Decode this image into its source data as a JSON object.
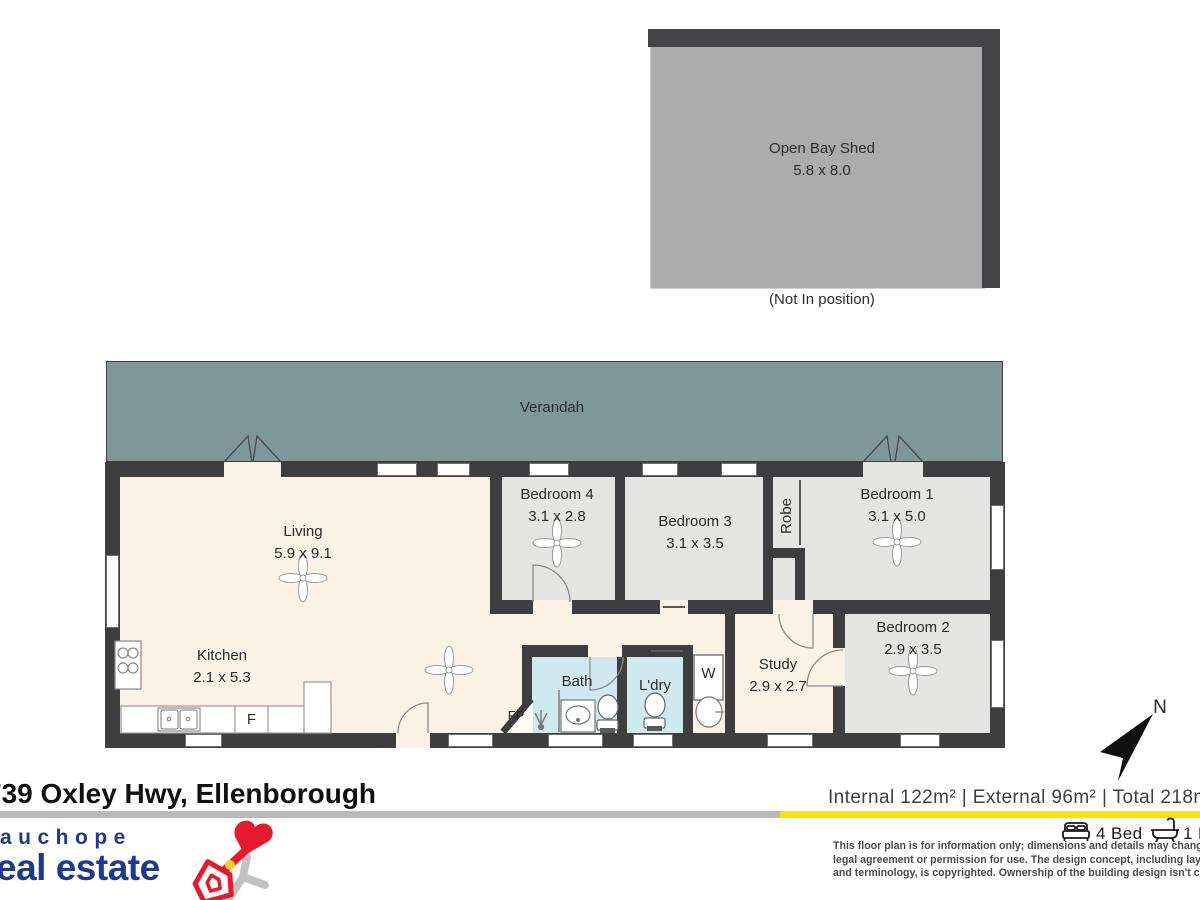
{
  "shed": {
    "label": "Open Bay Shed",
    "dims": "5.8 x 8.0",
    "note": "(Not In position)"
  },
  "plan": {
    "verandah": "Verandah",
    "rooms": [
      {
        "name": "Living",
        "dims": "5.9 x 9.1"
      },
      {
        "name": "Kitchen",
        "dims": "2.1 x 5.3"
      },
      {
        "name": "Bedroom 4",
        "dims": "3.1 x 2.8"
      },
      {
        "name": "Bedroom 3",
        "dims": "3.1 x 3.5"
      },
      {
        "name": "Bedroom 1",
        "dims": "3.1 x 5.0"
      },
      {
        "name": "Bedroom 2",
        "dims": "2.9 x 3.5"
      },
      {
        "name": "Study",
        "dims": "2.9 x 2.7"
      },
      {
        "name": "Bath"
      },
      {
        "name": "L'dry"
      }
    ],
    "robe": "Robe",
    "washer": "W",
    "fridge": "F",
    "fireplace": "FP",
    "compass": "N"
  },
  "footer": {
    "address": "739 Oxley Hwy, Ellenborough",
    "areas": "Internal 122m²   |   External 96m² | Total 218m²",
    "logo": {
      "top": "auchope",
      "bottom": "eal estate"
    },
    "beds_label": "4 Bed",
    "baths_label": "1 Bath",
    "disclaimer": [
      "This floor plan is for information only; dimensions and details may change. It's not a",
      "legal agreement or permission for use. The design concept, including layout, visuals,",
      "and terminology, is copyrighted. Ownership of the building design isn't claimed."
    ]
  },
  "colors": {
    "verandah": "#7E9798",
    "walls": "#3E3E40",
    "floor_cream": "#FAF2E5",
    "floor_grey": "#E4E4E3",
    "floor_wet": "#CFE9EF",
    "shed": "#ACACAC",
    "accent_yellow": "#FBE200",
    "divider_grey": "#B9B9B9",
    "brand_navy": "#1E3A8F",
    "brand_red": "#E8192C"
  }
}
